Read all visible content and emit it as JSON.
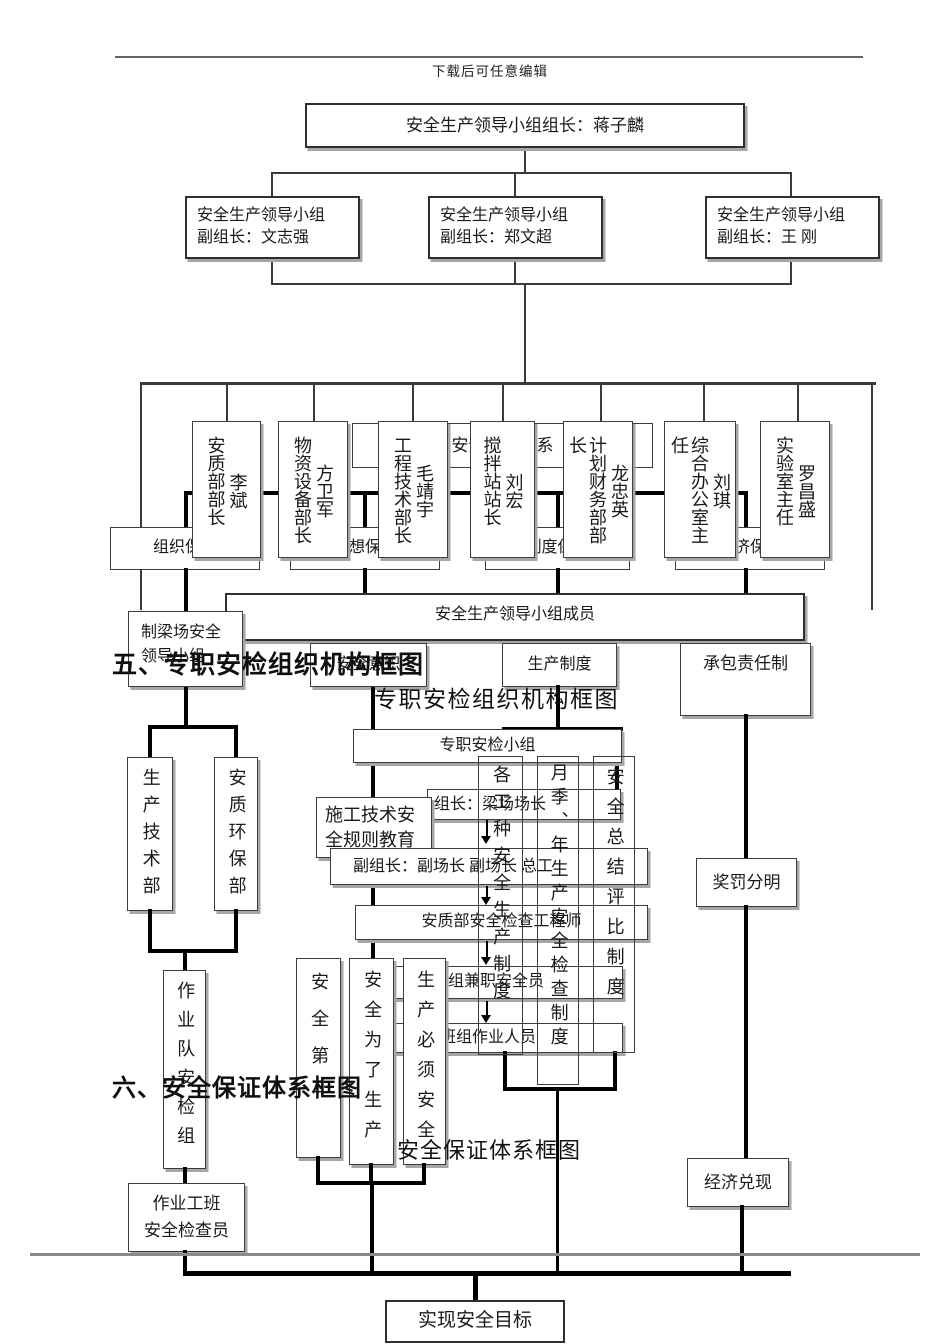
{
  "page": {
    "edit_note": "下载后可任意编辑"
  },
  "headings": {
    "section5": "五、专职安检组织机构框图",
    "title5": "专职安检组织机构框图",
    "section6": "六、安全保证体系框图",
    "title6": "安全保证体系框图"
  },
  "chart1": {
    "leader": "安全生产领导小组组长：蒋子麟",
    "deputies": [
      {
        "line1": "安全生产领导小组",
        "line2": "副组长：文志强"
      },
      {
        "line1": "安全生产领导小组",
        "line2": "副组长：郑文超"
      },
      {
        "line1": "安全生产领导小组",
        "line2": "副组长：王  刚"
      }
    ],
    "departments": [
      {
        "title": "安质部部长",
        "name": "李斌"
      },
      {
        "title": "物资设备部长",
        "name": "方卫军"
      },
      {
        "title": "工程技术部长",
        "name": "毛靖宇"
      },
      {
        "title": "搅拌站站长",
        "name": "刘宏"
      },
      {
        "title": "计划财务部部长",
        "name": "龙忠英"
      },
      {
        "title": "综合办公室主任",
        "name": "刘琪"
      },
      {
        "title": "实验室主任",
        "name": "罗昌盛"
      }
    ],
    "members": "安全生产领导小组成员"
  },
  "chart2": {
    "team": "专职安检小组",
    "leader": "组长：梁场场长",
    "deputy": "副组长：副场长  副场长  总工",
    "engineer": "安质部安全检查工程师",
    "part_time": "班组兼职安全员",
    "workers": "班组作业人员",
    "left": {
      "dept1": "生产技术部",
      "dept2": "安质环保部",
      "team": "作业队安检组",
      "inspector_line1": "作业工班",
      "inspector_line2": "安全检查员"
    }
  },
  "chart3": {
    "system_title": "安全保证体系",
    "pillars": [
      "组织保证",
      "思想保证",
      "制度保证",
      "经济保证"
    ],
    "beam_yard": {
      "line1": "制梁场安全",
      "line2": "领导小组"
    },
    "awareness": "安全意识",
    "production_system": "生产制度",
    "contract": "承包责任制",
    "education": {
      "line1": "施工技术安",
      "line2": "全规则教育"
    },
    "columns": [
      "各工种安全生产制度",
      "月季、年生产安全检查制度",
      "安全总结评比制度"
    ],
    "slogans": [
      "安全第一",
      "安全为了生产",
      "生产必须安全"
    ],
    "reward": "奖罚分明",
    "cash": "经济兑现",
    "goal": "实现安全目标"
  }
}
